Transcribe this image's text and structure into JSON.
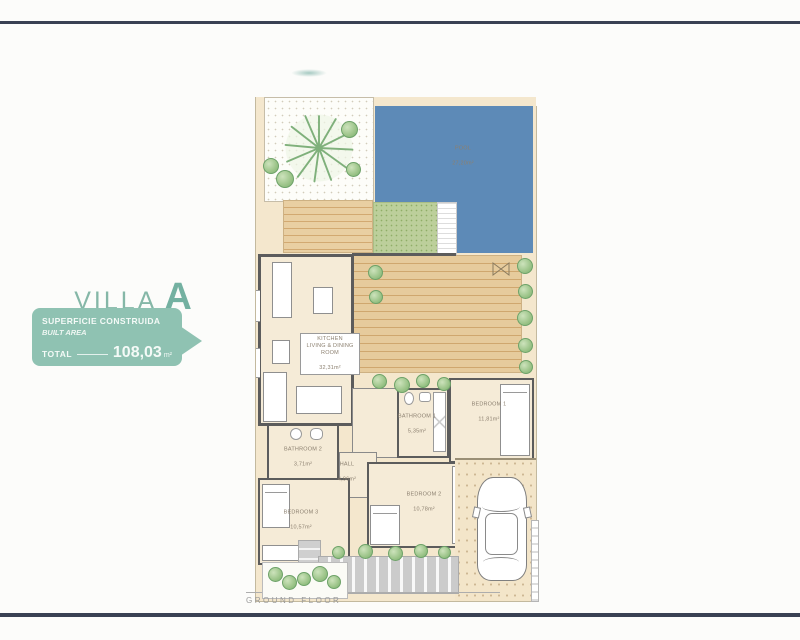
{
  "page": {
    "ground_floor_label": "GROUND FLOOR"
  },
  "header": {
    "title": "VILLA",
    "title_letter": "A"
  },
  "badge": {
    "line1": "SUPERFICIE CONSTRUIDA",
    "line2": "BUILT AREA",
    "total_label": "TOTAL",
    "total_value": "108,03",
    "total_unit": "m²"
  },
  "rooms": {
    "pool": {
      "name": "POOL",
      "area": "27,20m²"
    },
    "kitchen": {
      "name": "KITCHEN\nLIVING & DINING\nROOM",
      "area": "32,31m²"
    },
    "bedroom1": {
      "name": "BEDROOM 1",
      "area": "11,81m²"
    },
    "bathroom1": {
      "name": "BATHROOM 1",
      "area": "5,35m²"
    },
    "bathroom2": {
      "name": "BATHROOM 2",
      "area": "3,71m²"
    },
    "hall": {
      "name": "HALL",
      "area": "4,96m²"
    },
    "bedroom2": {
      "name": "BEDROOM 2",
      "area": "10,78m²"
    },
    "bedroom3": {
      "name": "BEDROOM 3",
      "area": "10,57m²"
    }
  },
  "colors": {
    "navy_rule": "#3a4153",
    "brand_teal": "#8fc2b2",
    "title_teal": "#85b7a7",
    "pool_blue": "#5d8ab7",
    "interior_cream": "#f5ebd7",
    "wood_deck": "#e6cb9c",
    "grass_green": "#bccf9b",
    "wall_gray": "#5c5c5c",
    "paving_beige": "#f4e7cd"
  }
}
